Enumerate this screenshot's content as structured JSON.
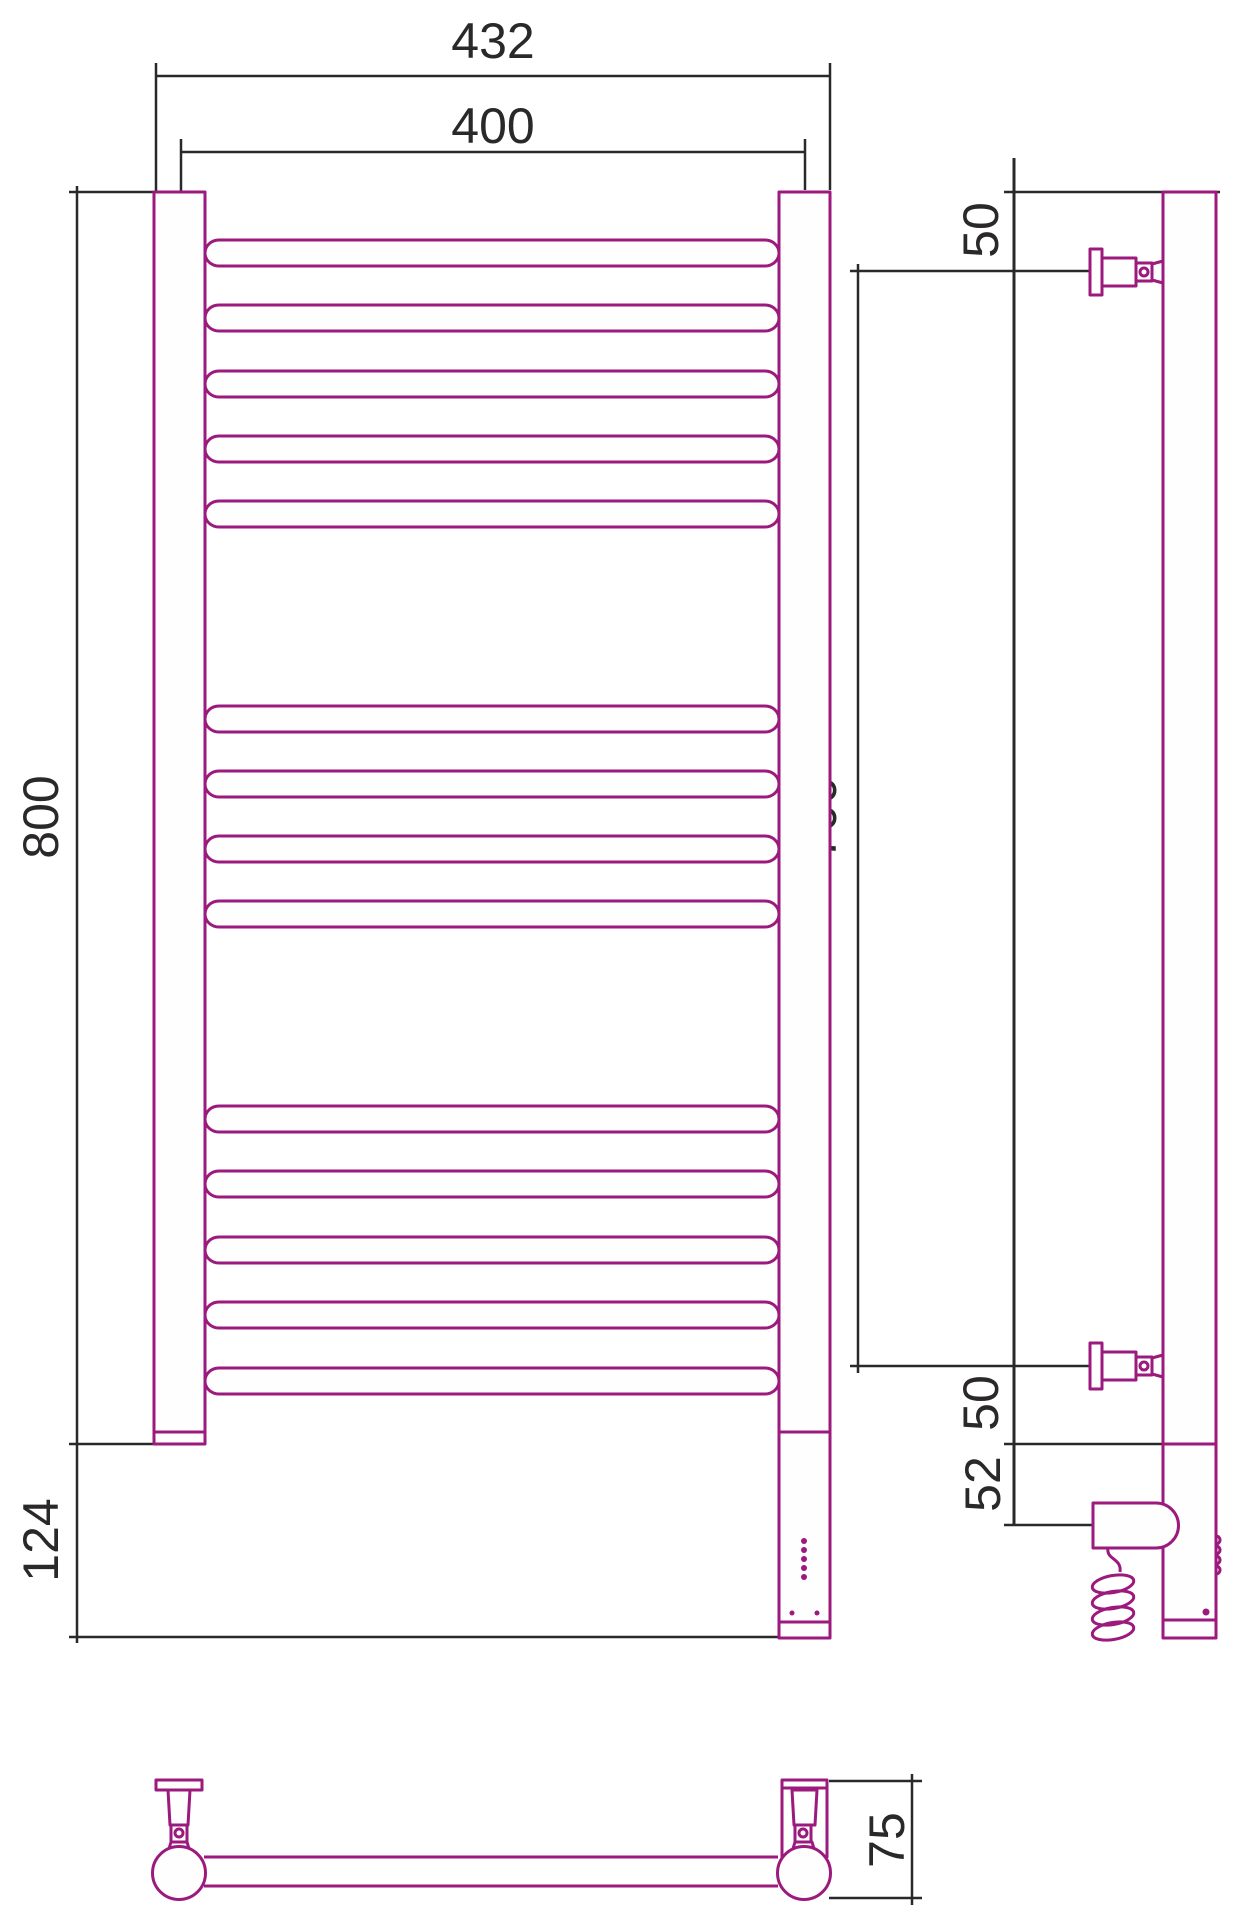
{
  "drawing": {
    "type": "technical-drawing",
    "subject": "ladder-style heated towel rail, three projections (front, side, bottom)",
    "units": "mm",
    "colors": {
      "product": "#9C1A7E",
      "dimension": "#2b282a",
      "background": "#ffffff",
      "fill": "#fefefe"
    },
    "dimensions": {
      "overall_width": "432",
      "rail_span": "400",
      "overall_height": "800",
      "heater_box_height": "124",
      "side_top_bracket_offset": "50",
      "side_bracket_span": "700",
      "side_bottom_bracket_offset": "50",
      "side_heater_offset": "52",
      "depth": "75"
    },
    "front": {
      "rail_count": 14,
      "rail_groups": [
        5,
        4,
        5
      ],
      "rail_height": 26,
      "rail_group_tops": [
        [
          240,
          305,
          371,
          436,
          501
        ],
        [
          706,
          771,
          836,
          901
        ],
        [
          1106,
          1171,
          1237,
          1302,
          1368
        ]
      ],
      "led_dot_column_count": 5,
      "led_dot_pair_count": 2
    }
  }
}
